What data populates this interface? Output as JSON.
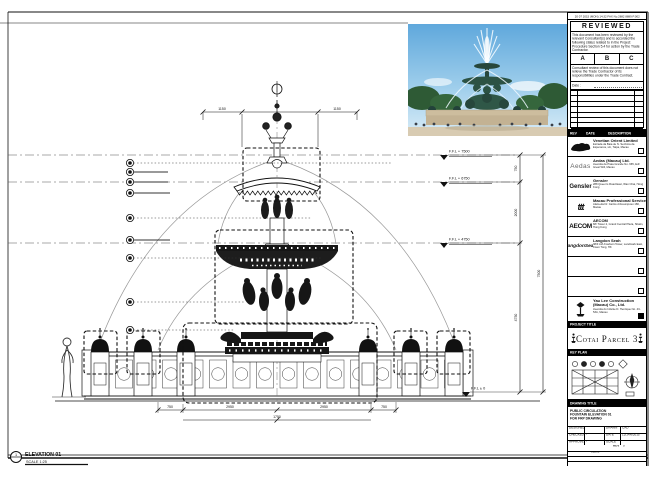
{
  "sheet": {
    "fax_header": "20 07 2015 (MON) 14:32 FAX No.2882 8889 P.002"
  },
  "stamp": {
    "title": "REVIEWED",
    "para1": "This document has been reviewed by the relevant Consultant(s) and is accorded the following status related to in the Project Procedure Section 5.4 for action by the Trade Contractor.",
    "options": [
      "A",
      "B",
      "C"
    ],
    "para2": "Consultant review of this document does not relieve the Trade Contractor of its responsibilities under the Trade Contract.",
    "date_label": "Date :"
  },
  "rev_bar": {
    "rev": "REV",
    "date": "DATE",
    "description": "DESCRIPTION",
    "by": "BY"
  },
  "consultants": [
    {
      "name": "Venetian Orient Limited",
      "line1": "Estrada da Baia de N. Senhora da Esperanca, s/n, Taipa, Macau",
      "line2": "T +853 2882 8888   F +853 2882 8889"
    },
    {
      "logo_text": "Aedas",
      "name": "Aedas (Macau) Ltd.",
      "line1": "Avenida da Praia Grande No. 665, Edf. Great Will, Macau",
      "line2": "T +853 2833 1822   F +853 2835 6925"
    },
    {
      "logo_text": "Gensler",
      "name": "Gensler",
      "line1": "288 Queen's Road East, Wan Chai, Hong Kong",
      "line2": "T +852 2591 0100"
    },
    {
      "logo_text": "ttt",
      "name": "Macau Professional Services Ltd.",
      "line1": "Alameda Dr. Carlos d'Assumpcao 180, Macau",
      "line2": "T +853 2875 1188"
    },
    {
      "logo_text": "AECOM",
      "name": "AECOM",
      "line1": "8/F Tower 2, Grand Central Plaza, Shatin, Hong Kong",
      "line2": "T +852 3922 9000"
    },
    {
      "logo_text": "LangdonSeah",
      "name": "Langdon Seah",
      "line1": "38/F AIA Kowloon Tower, Landmark East, Kwun Tong, HK",
      "line2": "T +852 2830 3500"
    }
  ],
  "contractor": {
    "name": "Yau Lee Construction (Macau) Co., Ltd.",
    "line1": "Avenida do Infante D. Henrique No. 43-53A, Macau",
    "line2": "T +853 2832 2218   F +853 2832 2238"
  },
  "project": {
    "label": "PROJECT TITLE",
    "name": "Cotai Parcel 3"
  },
  "key_plan": {
    "label": "KEY PLAN",
    "right_note": "PARCEL 1, LOT 3"
  },
  "title_block": {
    "bar_label": "DRAWING TITLE",
    "title_line1": "PUBLIC CIRCULATION",
    "title_line2": "FOUNTAIN ELEVATION 01",
    "title_line3": "FOR FRP DRAWING",
    "rows": [
      {
        "l1": "DESIGNED",
        "v1": "",
        "l2": "DRAWN",
        "v2": "CAD"
      },
      {
        "l1": "CHECKED",
        "v1": "-",
        "l2": "DATE",
        "v2": "12/JAN/2015"
      },
      {
        "l1": "APPROVED",
        "v1": "-",
        "l2": "SCALE",
        "v2": "AS SHOWN"
      }
    ],
    "dwg_label": "DWG NO.",
    "dwg_no": "P3-M_PD_25101",
    "rev_label": "REV",
    "rev": "0",
    "job_label": "JOB NUMBER",
    "job": "31203",
    "cad_label": "CAD FILE NAME",
    "cad": "P3-M_PD_25101.dwg",
    "ref_label": "REF. CAD FILE NAME",
    "ref": "-"
  },
  "drawing": {
    "top_dims": [
      "1150",
      "1150"
    ],
    "levels": [
      "F.F.L + 7500",
      "F.F.L + 6750",
      "F.F.L + 4750",
      "F.F.L ± 0"
    ],
    "vdims": [
      "750",
      "2000",
      "4750",
      "7500"
    ],
    "bottom_dims": [
      "750",
      "2950",
      "2950",
      "750"
    ],
    "bottom_center_dim": "1750",
    "elevation_bubble": "1",
    "elevation_label": "ELEVATION 01",
    "elevation_scale": "SCALE 1:25"
  }
}
